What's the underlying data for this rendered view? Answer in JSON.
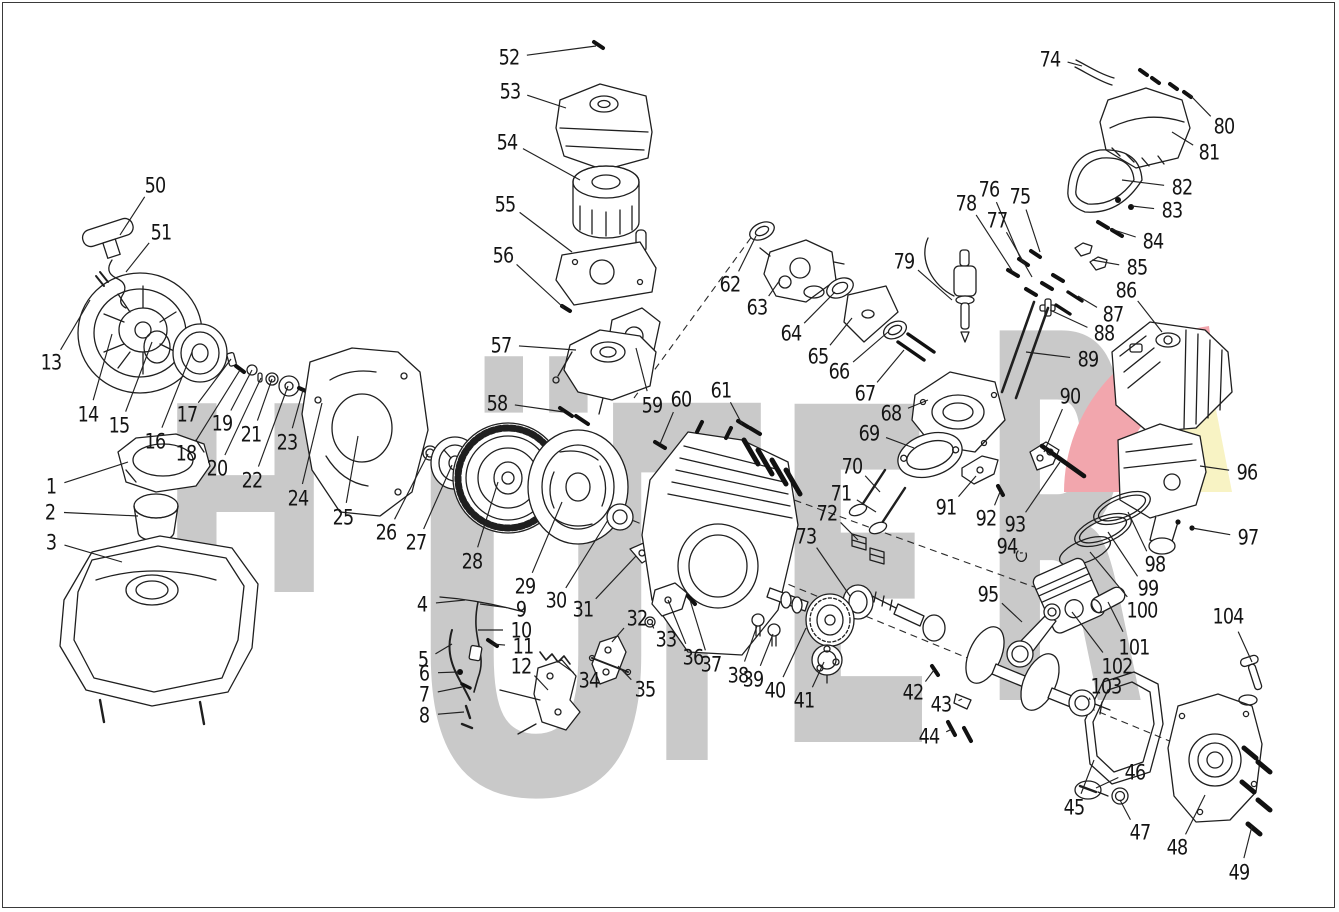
{
  "meta": {
    "kind": "exploded-parts-diagram",
    "description": "Engine exploded view parts diagram with numbered callouts 1-104",
    "canvas": {
      "width": 1339,
      "height": 912
    },
    "border_color": "#3a3a3a",
    "line_color": "#1f1f1f",
    "label_color": "#141414"
  },
  "watermark": {
    "text": "HÜTER",
    "color": "#c9c9c9",
    "swoosh_pink": "#f2a6ad",
    "swoosh_yellow": "#f8f3c4",
    "letters": [
      {
        "ch": "H",
        "x": 158,
        "w": 175,
        "baseline": 592,
        "size": 259
      },
      {
        "ch": "Ü",
        "x": 400,
        "w": 272,
        "baseline": 792,
        "size": 470
      },
      {
        "ch": "T",
        "x": 612,
        "w": 150,
        "baseline": 760,
        "size": 490
      },
      {
        "ch": "E",
        "x": 772,
        "w": 168,
        "baseline": 742,
        "size": 464
      },
      {
        "ch": "R",
        "x": 980,
        "w": 165,
        "baseline": 700,
        "size": 507
      }
    ]
  },
  "diagram": {
    "dashed_axes": [
      {
        "x1": 758,
        "y1": 228,
        "x2": 634,
        "y2": 398
      },
      {
        "x1": 622,
        "y1": 516,
        "x2": 1245,
        "y2": 772
      },
      {
        "x1": 772,
        "y1": 492,
        "x2": 1048,
        "y2": 592
      }
    ],
    "callouts": [
      {
        "n": "1",
        "lx": 51,
        "ly": 486,
        "tx": 128,
        "ty": 462
      },
      {
        "n": "2",
        "lx": 50,
        "ly": 512,
        "tx": 138,
        "ty": 516
      },
      {
        "n": "3",
        "lx": 51,
        "ly": 542,
        "tx": 122,
        "ty": 562
      },
      {
        "n": "4",
        "lx": 422,
        "ly": 604,
        "tx": 465,
        "ty": 600
      },
      {
        "n": "5",
        "lx": 423,
        "ly": 659,
        "tx": 452,
        "ty": 644
      },
      {
        "n": "6",
        "lx": 424,
        "ly": 673,
        "tx": 458,
        "ty": 672
      },
      {
        "n": "7",
        "lx": 424,
        "ly": 694,
        "tx": 462,
        "ty": 687
      },
      {
        "n": "8",
        "lx": 424,
        "ly": 715,
        "tx": 464,
        "ty": 712
      },
      {
        "n": "9",
        "lx": 521,
        "ly": 609,
        "tx": 480,
        "ty": 604
      },
      {
        "n": "10",
        "lx": 521,
        "ly": 630,
        "tx": 478,
        "ty": 630
      },
      {
        "n": "11",
        "lx": 523,
        "ly": 646,
        "tx": 492,
        "ty": 644
      },
      {
        "n": "12",
        "lx": 521,
        "ly": 666,
        "tx": 548,
        "ty": 690
      },
      {
        "n": "13",
        "lx": 51,
        "ly": 362,
        "tx": 90,
        "ty": 300
      },
      {
        "n": "14",
        "lx": 88,
        "ly": 414,
        "tx": 112,
        "ty": 334
      },
      {
        "n": "15",
        "lx": 119,
        "ly": 425,
        "tx": 152,
        "ty": 342
      },
      {
        "n": "16",
        "lx": 155,
        "ly": 441,
        "tx": 192,
        "ty": 352
      },
      {
        "n": "17",
        "lx": 187,
        "ly": 414,
        "tx": 231,
        "ty": 359
      },
      {
        "n": "18",
        "lx": 186,
        "ly": 453,
        "tx": 240,
        "ty": 370
      },
      {
        "n": "19",
        "lx": 222,
        "ly": 423,
        "tx": 252,
        "ty": 370
      },
      {
        "n": "20",
        "lx": 217,
        "ly": 468,
        "tx": 261,
        "ty": 378
      },
      {
        "n": "21",
        "lx": 251,
        "ly": 434,
        "tx": 272,
        "ty": 379
      },
      {
        "n": "22",
        "lx": 252,
        "ly": 480,
        "tx": 288,
        "ty": 386
      },
      {
        "n": "23",
        "lx": 287,
        "ly": 442,
        "tx": 303,
        "ty": 390
      },
      {
        "n": "24",
        "lx": 298,
        "ly": 498,
        "tx": 322,
        "ty": 403
      },
      {
        "n": "25",
        "lx": 343,
        "ly": 517,
        "tx": 358,
        "ty": 436
      },
      {
        "n": "26",
        "lx": 386,
        "ly": 532,
        "tx": 428,
        "ty": 454
      },
      {
        "n": "27",
        "lx": 416,
        "ly": 542,
        "tx": 452,
        "ty": 465
      },
      {
        "n": "28",
        "lx": 472,
        "ly": 561,
        "tx": 498,
        "ty": 482
      },
      {
        "n": "29",
        "lx": 525,
        "ly": 586,
        "tx": 562,
        "ty": 502
      },
      {
        "n": "30",
        "lx": 556,
        "ly": 600,
        "tx": 608,
        "ty": 520
      },
      {
        "n": "31",
        "lx": 583,
        "ly": 609,
        "tx": 636,
        "ty": 556
      },
      {
        "n": "32",
        "lx": 637,
        "ly": 618,
        "tx": 612,
        "ty": 642
      },
      {
        "n": "33",
        "lx": 666,
        "ly": 639,
        "tx": 652,
        "ty": 624
      },
      {
        "n": "34",
        "lx": 589,
        "ly": 680,
        "tx": 556,
        "ty": 660
      },
      {
        "n": "35",
        "lx": 645,
        "ly": 689,
        "tx": 618,
        "ty": 666
      },
      {
        "n": "36",
        "lx": 693,
        "ly": 657,
        "tx": 668,
        "ty": 600
      },
      {
        "n": "37",
        "lx": 711,
        "ly": 664,
        "tx": 690,
        "ty": 600
      },
      {
        "n": "38",
        "lx": 738,
        "ly": 675,
        "tx": 757,
        "ty": 626
      },
      {
        "n": "39",
        "lx": 753,
        "ly": 679,
        "tx": 773,
        "ty": 634
      },
      {
        "n": "40",
        "lx": 775,
        "ly": 690,
        "tx": 806,
        "ty": 628
      },
      {
        "n": "41",
        "lx": 804,
        "ly": 700,
        "tx": 824,
        "ty": 662
      },
      {
        "n": "42",
        "lx": 913,
        "ly": 692,
        "tx": 934,
        "ty": 670
      },
      {
        "n": "43",
        "lx": 941,
        "ly": 704,
        "tx": 962,
        "ty": 699
      },
      {
        "n": "44",
        "lx": 929,
        "ly": 736,
        "tx": 952,
        "ty": 729
      },
      {
        "n": "45",
        "lx": 1074,
        "ly": 807,
        "tx": 1094,
        "ty": 760
      },
      {
        "n": "46",
        "lx": 1135,
        "ly": 772,
        "tx": 1096,
        "ty": 788
      },
      {
        "n": "47",
        "lx": 1140,
        "ly": 832,
        "tx": 1120,
        "ty": 800
      },
      {
        "n": "48",
        "lx": 1177,
        "ly": 847,
        "tx": 1205,
        "ty": 795
      },
      {
        "n": "49",
        "lx": 1239,
        "ly": 872,
        "tx": 1252,
        "ty": 826
      },
      {
        "n": "50",
        "lx": 155,
        "ly": 185,
        "tx": 120,
        "ty": 235
      },
      {
        "n": "51",
        "lx": 161,
        "ly": 232,
        "tx": 126,
        "ty": 272
      },
      {
        "n": "52",
        "lx": 509,
        "ly": 57,
        "tx": 596,
        "ty": 46
      },
      {
        "n": "53",
        "lx": 510,
        "ly": 91,
        "tx": 566,
        "ty": 108
      },
      {
        "n": "54",
        "lx": 507,
        "ly": 142,
        "tx": 580,
        "ty": 180
      },
      {
        "n": "55",
        "lx": 505,
        "ly": 204,
        "tx": 572,
        "ty": 252
      },
      {
        "n": "56",
        "lx": 503,
        "ly": 255,
        "tx": 564,
        "ty": 308
      },
      {
        "n": "57",
        "lx": 501,
        "ly": 345,
        "tx": 576,
        "ty": 350
      },
      {
        "n": "58",
        "lx": 497,
        "ly": 403,
        "tx": 564,
        "ty": 412
      },
      {
        "n": "59",
        "lx": 652,
        "ly": 405,
        "tx": 636,
        "ty": 348
      },
      {
        "n": "60",
        "lx": 681,
        "ly": 399,
        "tx": 660,
        "ty": 444
      },
      {
        "n": "61",
        "lx": 721,
        "ly": 390,
        "tx": 742,
        "ty": 424
      },
      {
        "n": "62",
        "lx": 730,
        "ly": 284,
        "tx": 756,
        "ty": 236
      },
      {
        "n": "63",
        "lx": 757,
        "ly": 307,
        "tx": 780,
        "ty": 280
      },
      {
        "n": "64",
        "lx": 791,
        "ly": 333,
        "tx": 835,
        "ty": 292
      },
      {
        "n": "65",
        "lx": 818,
        "ly": 356,
        "tx": 852,
        "ty": 318
      },
      {
        "n": "66",
        "lx": 839,
        "ly": 371,
        "tx": 888,
        "ty": 332
      },
      {
        "n": "67",
        "lx": 865,
        "ly": 393,
        "tx": 904,
        "ty": 350
      },
      {
        "n": "68",
        "lx": 891,
        "ly": 413,
        "tx": 928,
        "ty": 400
      },
      {
        "n": "69",
        "lx": 869,
        "ly": 433,
        "tx": 914,
        "ty": 448
      },
      {
        "n": "70",
        "lx": 852,
        "ly": 466,
        "tx": 880,
        "ty": 492
      },
      {
        "n": "71",
        "lx": 841,
        "ly": 493,
        "tx": 876,
        "ty": 512
      },
      {
        "n": "72",
        "lx": 827,
        "ly": 513,
        "tx": 858,
        "ty": 540
      },
      {
        "n": "73",
        "lx": 806,
        "ly": 536,
        "tx": 850,
        "ty": 596
      },
      {
        "n": "74",
        "lx": 1050,
        "ly": 59,
        "tx": 1082,
        "ty": 66
      },
      {
        "n": "75",
        "lx": 1020,
        "ly": 196,
        "tx": 1040,
        "ty": 252
      },
      {
        "n": "76",
        "lx": 989,
        "ly": 189,
        "tx": 1022,
        "ty": 262
      },
      {
        "n": "77",
        "lx": 997,
        "ly": 220,
        "tx": 1032,
        "ty": 277
      },
      {
        "n": "78",
        "lx": 966,
        "ly": 203,
        "tx": 1013,
        "ty": 272
      },
      {
        "n": "79",
        "lx": 904,
        "ly": 261,
        "tx": 952,
        "ty": 300
      },
      {
        "n": "80",
        "lx": 1224,
        "ly": 126,
        "tx": 1190,
        "ty": 95
      },
      {
        "n": "81",
        "lx": 1209,
        "ly": 152,
        "tx": 1172,
        "ty": 132
      },
      {
        "n": "82",
        "lx": 1182,
        "ly": 187,
        "tx": 1122,
        "ty": 180
      },
      {
        "n": "83",
        "lx": 1172,
        "ly": 210,
        "tx": 1132,
        "ty": 206
      },
      {
        "n": "84",
        "lx": 1153,
        "ly": 241,
        "tx": 1108,
        "ty": 228
      },
      {
        "n": "85",
        "lx": 1137,
        "ly": 267,
        "tx": 1092,
        "ty": 260
      },
      {
        "n": "86",
        "lx": 1126,
        "ly": 290,
        "tx": 1162,
        "ty": 332
      },
      {
        "n": "87",
        "lx": 1113,
        "ly": 314,
        "tx": 1078,
        "ty": 296
      },
      {
        "n": "88",
        "lx": 1104,
        "ly": 333,
        "tx": 1050,
        "ty": 310
      },
      {
        "n": "89",
        "lx": 1088,
        "ly": 359,
        "tx": 1026,
        "ty": 352
      },
      {
        "n": "90",
        "lx": 1070,
        "ly": 396,
        "tx": 1044,
        "ty": 452
      },
      {
        "n": "91",
        "lx": 946,
        "ly": 507,
        "tx": 976,
        "ty": 476
      },
      {
        "n": "92",
        "lx": 986,
        "ly": 518,
        "tx": 1000,
        "ty": 492
      },
      {
        "n": "93",
        "lx": 1015,
        "ly": 524,
        "tx": 1060,
        "ty": 462
      },
      {
        "n": "94",
        "lx": 1007,
        "ly": 546,
        "tx": 1020,
        "ty": 553
      },
      {
        "n": "95",
        "lx": 988,
        "ly": 594,
        "tx": 1022,
        "ty": 622
      },
      {
        "n": "96",
        "lx": 1247,
        "ly": 472,
        "tx": 1200,
        "ty": 466
      },
      {
        "n": "97",
        "lx": 1248,
        "ly": 537,
        "tx": 1192,
        "ty": 528
      },
      {
        "n": "98",
        "lx": 1155,
        "ly": 564,
        "tx": 1128,
        "ty": 512
      },
      {
        "n": "99",
        "lx": 1148,
        "ly": 588,
        "tx": 1108,
        "ty": 532
      },
      {
        "n": "100",
        "lx": 1142,
        "ly": 610,
        "tx": 1090,
        "ty": 552
      },
      {
        "n": "101",
        "lx": 1134,
        "ly": 647,
        "tx": 1108,
        "ty": 602
      },
      {
        "n": "102",
        "lx": 1117,
        "ly": 666,
        "tx": 1072,
        "ty": 612
      },
      {
        "n": "103",
        "lx": 1106,
        "ly": 686,
        "tx": 1090,
        "ty": 700
      },
      {
        "n": "104",
        "lx": 1228,
        "ly": 616,
        "tx": 1252,
        "ty": 662
      }
    ]
  }
}
